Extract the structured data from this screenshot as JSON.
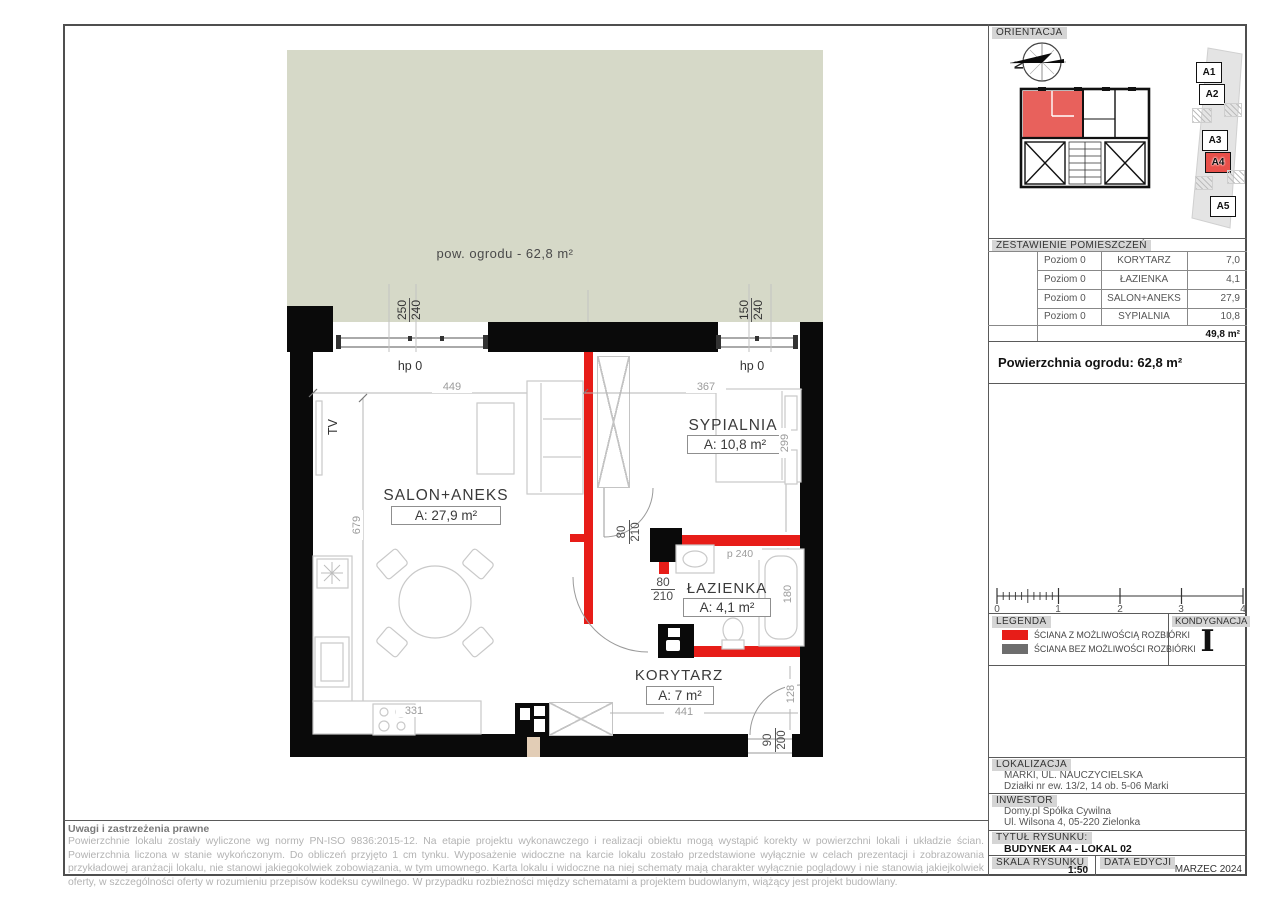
{
  "colors": {
    "accent_red": "#e71d18",
    "garden": "#d6d9c8",
    "wall_black": "#0a0a0a",
    "gray_wall": "#6d6d6d"
  },
  "plan": {
    "garden_label": "pow. ogrodu -  62,8 m²",
    "tv_label": "TV",
    "rooms": [
      {
        "name": "SALON+ANEKS",
        "area": "A: 27,9 m²"
      },
      {
        "name": "SYPIALNIA",
        "area": "A: 10,8 m²"
      },
      {
        "name": "ŁAZIENKA",
        "area": "A: 4,1 m²"
      },
      {
        "name": "KORYTARZ",
        "area": "A: 7 m²"
      }
    ],
    "dims": {
      "salon_width": "449",
      "bedroom_width": "367",
      "salon_height": "679",
      "bedroom_height": "299",
      "bath_height": "180",
      "corridor_width": "441",
      "kitchen": "331",
      "entry_side": "128",
      "p240": "p 240",
      "hp0_left": "hp 0",
      "hp0_right": "hp 0",
      "win_left_top": "250",
      "win_left_bottom": "240",
      "win_right_top": "150",
      "win_right_bottom": "240",
      "door1_w": "80",
      "door1_h": "210",
      "door2_w": "80",
      "door2_h": "210",
      "entry_w": "90",
      "entry_h": "200"
    }
  },
  "titleblock": {
    "orient": {
      "label": "ORIENTACJA",
      "north": "N",
      "units": [
        "A1",
        "A2",
        "A3",
        "A4",
        "A5"
      ],
      "highlighted_unit": "A4"
    },
    "zest": {
      "label": "ZESTAWIENIE POMIESZCZEŃ",
      "rows": [
        {
          "level": "Poziom 0",
          "room": "KORYTARZ",
          "area": "7,0"
        },
        {
          "level": "Poziom 0",
          "room": "ŁAZIENKA",
          "area": "4,1"
        },
        {
          "level": "Poziom 0",
          "room": "SALON+ANEKS",
          "area": "27,9"
        },
        {
          "level": "Poziom 0",
          "room": "SYPIALNIA",
          "area": "10,8"
        }
      ],
      "total": "49,8 m²"
    },
    "garden_total": "Powierzchnia ogrodu: 62,8 m²",
    "scale": {
      "ticks": [
        "0",
        "1",
        "2",
        "3",
        "4"
      ]
    },
    "legend": {
      "label": "LEGENDA",
      "items": [
        {
          "text": "ŚCIANA Z MOŻLIWOŚCIĄ ROZBIÓRKI",
          "color": "#e71d18"
        },
        {
          "text": "ŚCIANA BEZ MOŻLIWOŚCI ROZBIÓRKI",
          "color": "#6d6d6d"
        }
      ]
    },
    "kond": {
      "label": "KONDYGNACJA",
      "value": "I"
    },
    "lok": {
      "label": "LOKALIZACJA",
      "line1": "MARKI, UL. NAUCZYCIELSKA",
      "line2": "Działki nr ew. 13/2, 14 ob. 5-06 Marki"
    },
    "inw": {
      "label": "INWESTOR",
      "line1": "Domy.pl Spółka Cywilna",
      "line2": "Ul. Wilsona 4, 05-220 Zielonka"
    },
    "tytul": {
      "label": "TYTUŁ RYSUNKU:",
      "value": "BUDYNEK A4 - LOKAL 02"
    },
    "skala": {
      "label": "SKALA RYSUNKU",
      "value": "1:50"
    },
    "data_ed": {
      "label": "DATA EDYCJI",
      "value": "MARZEC 2024"
    }
  },
  "disclaimer": {
    "title": "Uwagi i zastrzeżenia prawne",
    "body": "Powierzchnie lokalu zostały wyliczone wg normy PN-ISO 9836:2015-12. Na etapie projektu wykonawczego i realizacji obiektu mogą wystąpić korekty w powierzchni lokali i układzie ścian. Powierzchnia liczona w stanie wykończonym. Do obliczeń przyjęto 1 cm tynku.  Wyposażenie widoczne na karcie lokalu zostało przedstawione wyłącznie w celach prezentacji i zobrazowania przykładowej aranżacji lokalu, nie stanowi jakiegokolwiek zobowiązania, w tym umownego. Karta lokalu i widoczne na niej schematy mają charakter wyłącznie poglądowy i nie stanowią jakiejkolwiek oferty, w szczególności oferty w rozumieniu przepisów kodeksu cywilnego. W przypadku rozbieżności między schematami a projektem budowlanym, wiążący jest projekt budowlany."
  }
}
